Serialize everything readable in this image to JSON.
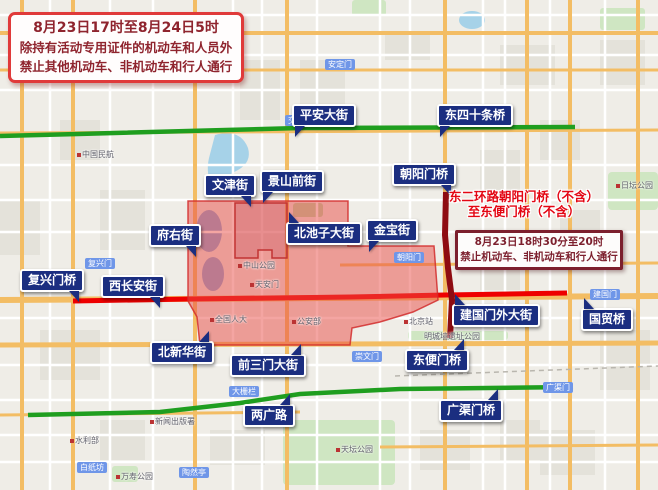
{
  "notices": {
    "main": {
      "line1": "8月23日17时至8月24日5时",
      "line2": "除持有活动专用证件的机动车和人员外",
      "line3": "禁止其他机动车、非机动车和行人通行"
    },
    "east_ring_caption": {
      "line1": "东二环路朝阳门桥（不含）",
      "line2": "至东便门桥（不含）"
    },
    "east_ring_box": {
      "line1": "8月23日18时30分至20时",
      "line2": "禁止机动车、非机动车和行人通行"
    }
  },
  "street_labels": [
    {
      "label": "平安大街",
      "x": 292,
      "y": 104,
      "tail": "bl"
    },
    {
      "label": "东四十条桥",
      "x": 437,
      "y": 104,
      "tail": "bl"
    },
    {
      "label": "朝阳门桥",
      "x": 392,
      "y": 163,
      "tail": "br"
    },
    {
      "label": "文津街",
      "x": 204,
      "y": 174,
      "tail": "br"
    },
    {
      "label": "景山前街",
      "x": 260,
      "y": 170,
      "tail": "bl"
    },
    {
      "label": "北池子大街",
      "x": 286,
      "y": 222,
      "tail": "tl"
    },
    {
      "label": "金宝街",
      "x": 366,
      "y": 219,
      "tail": "bl"
    },
    {
      "label": "府右街",
      "x": 149,
      "y": 224,
      "tail": "br"
    },
    {
      "label": "复兴门桥",
      "x": 20,
      "y": 269,
      "tail": "br"
    },
    {
      "label": "西长安街",
      "x": 101,
      "y": 275,
      "tail": "br"
    },
    {
      "label": "北新华街",
      "x": 150,
      "y": 341,
      "tail": "tr"
    },
    {
      "label": "前三门大街",
      "x": 230,
      "y": 354,
      "tail": "tr"
    },
    {
      "label": "东便门桥",
      "x": 405,
      "y": 349,
      "tail": "tr"
    },
    {
      "label": "建国门外大街",
      "x": 452,
      "y": 304,
      "tail": "tl"
    },
    {
      "label": "国贸桥",
      "x": 581,
      "y": 308,
      "tail": "tl"
    },
    {
      "label": "两广路",
      "x": 243,
      "y": 404,
      "tail": "tr"
    },
    {
      "label": "广渠门桥",
      "x": 439,
      "y": 399,
      "tail": "tr"
    }
  ],
  "poi_labels": [
    {
      "label": "北京大学人民医院",
      "x": 25,
      "y": 57,
      "icon": false
    },
    {
      "label": "中国民航",
      "x": 77,
      "y": 150,
      "icon": true
    },
    {
      "label": "中山公园",
      "x": 238,
      "y": 261,
      "icon": true
    },
    {
      "label": "天安门",
      "x": 250,
      "y": 280,
      "icon": true
    },
    {
      "label": "全国人大",
      "x": 210,
      "y": 315,
      "icon": true
    },
    {
      "label": "公安部",
      "x": 292,
      "y": 317,
      "icon": true
    },
    {
      "label": "北京站",
      "x": 404,
      "y": 317,
      "icon": true
    },
    {
      "label": "天坛公园",
      "x": 336,
      "y": 445,
      "icon": true
    },
    {
      "label": "万寿公园",
      "x": 116,
      "y": 472,
      "icon": true
    },
    {
      "label": "水利部",
      "x": 70,
      "y": 436,
      "icon": true
    },
    {
      "label": "新闻出版署",
      "x": 150,
      "y": 417,
      "icon": true
    },
    {
      "label": "日坛公园",
      "x": 616,
      "y": 181,
      "icon": true
    },
    {
      "label": "明城墙遗址公园",
      "x": 424,
      "y": 332,
      "icon": false
    }
  ],
  "road_badges": [
    {
      "label": "交道口",
      "x": 285,
      "y": 115
    },
    {
      "label": "安定门",
      "x": 325,
      "y": 59
    },
    {
      "label": "朝阳门",
      "x": 394,
      "y": 252
    },
    {
      "label": "建国门",
      "x": 590,
      "y": 289
    },
    {
      "label": "崇文门",
      "x": 352,
      "y": 351
    },
    {
      "label": "大栅栏",
      "x": 229,
      "y": 386
    },
    {
      "label": "陶然亭",
      "x": 179,
      "y": 467
    },
    {
      "label": "白纸坊",
      "x": 77,
      "y": 462
    },
    {
      "label": "广渠门",
      "x": 543,
      "y": 382
    },
    {
      "label": "复兴门",
      "x": 85,
      "y": 258
    }
  ],
  "colors": {
    "restricted_zone_fill": "#e94b46",
    "open_road_green": "#1f9e1f",
    "closed_road_red": "#ee0000",
    "closed_ring_dark_red": "#8e0c12",
    "street_label_navy": "#1b2e80",
    "notice_border_red": "#e03a3a",
    "notice_border_maroon": "#7c1f2d"
  }
}
